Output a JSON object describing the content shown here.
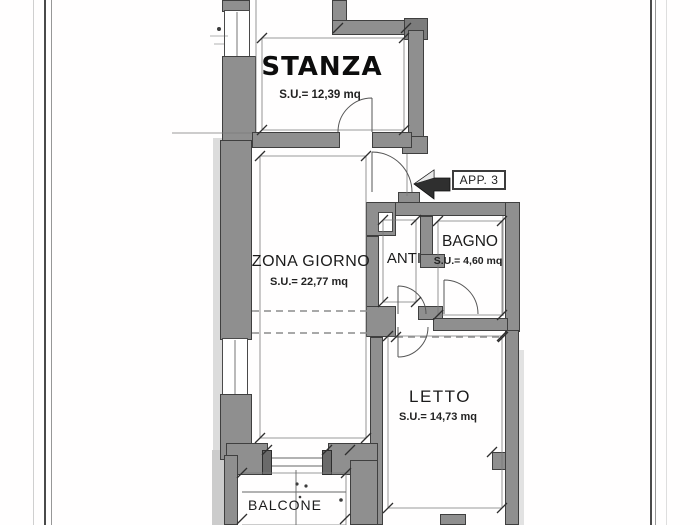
{
  "floorplan": {
    "unit_label": "APP. 3",
    "rooms": {
      "stanza": {
        "name": "STANZA",
        "area": "S.U.= 12,39 mq"
      },
      "zona_giorno": {
        "name": "ZONA GIORNO",
        "area": "S.U.= 22,77 mq"
      },
      "anti": {
        "name": "ANTI"
      },
      "bagno": {
        "name": "BAGNO",
        "area": "S.U.= 4,60 mq"
      },
      "letto": {
        "name": "LETTO",
        "area": "S.U.= 14,73 mq"
      },
      "balcone": {
        "name": "BALCONE"
      }
    },
    "colors": {
      "wall_fill": "#8f8f8f",
      "wall_edge": "#3f3f3f",
      "line": "#777777",
      "text": "#1b1b1b",
      "paper": "#ffffff"
    }
  }
}
